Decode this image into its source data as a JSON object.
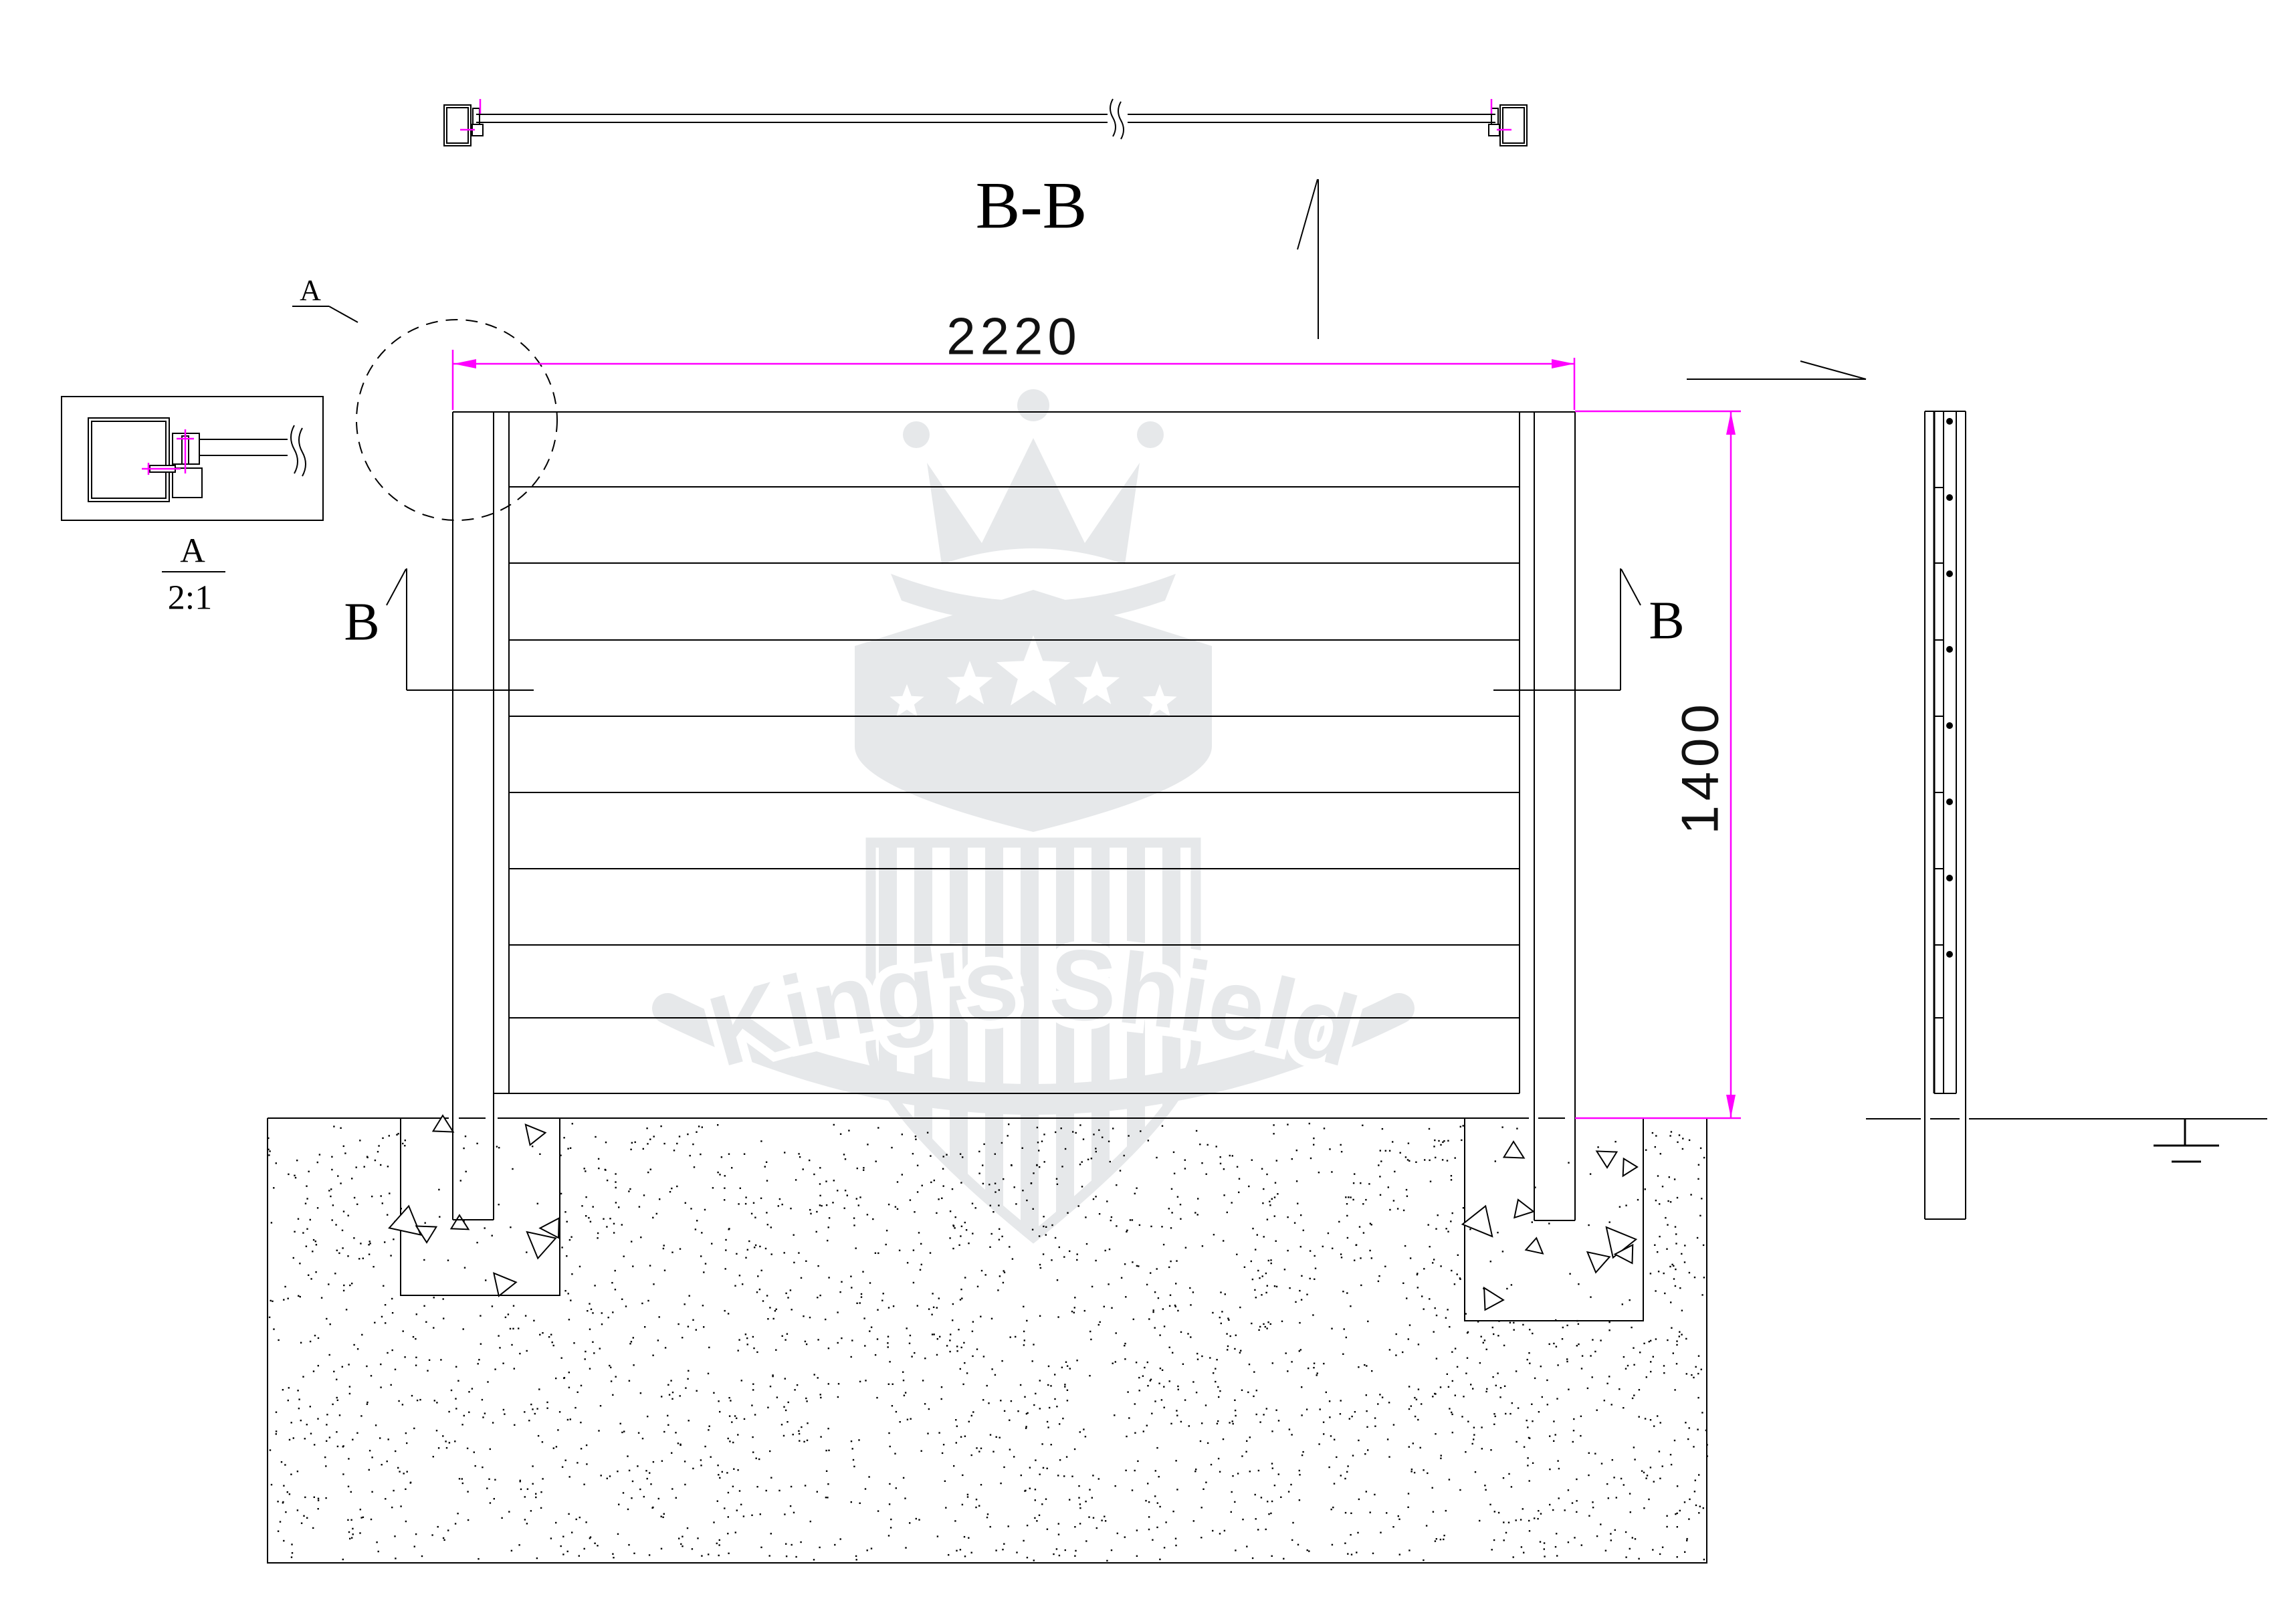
{
  "watermark": {
    "text": "King's Shield"
  },
  "views": {
    "section_title": "B-B",
    "detail_callout": "A",
    "detail_title": "A",
    "detail_scale": "2:1",
    "section_mark_left": "B",
    "section_mark_right": "B"
  },
  "dimensions": {
    "width": "2220",
    "height": "1400"
  },
  "colors": {
    "line": "#000000",
    "dimension": "#ff00ff",
    "watermark": "#e6e8ea",
    "background": "#ffffff",
    "text": "#000000"
  }
}
